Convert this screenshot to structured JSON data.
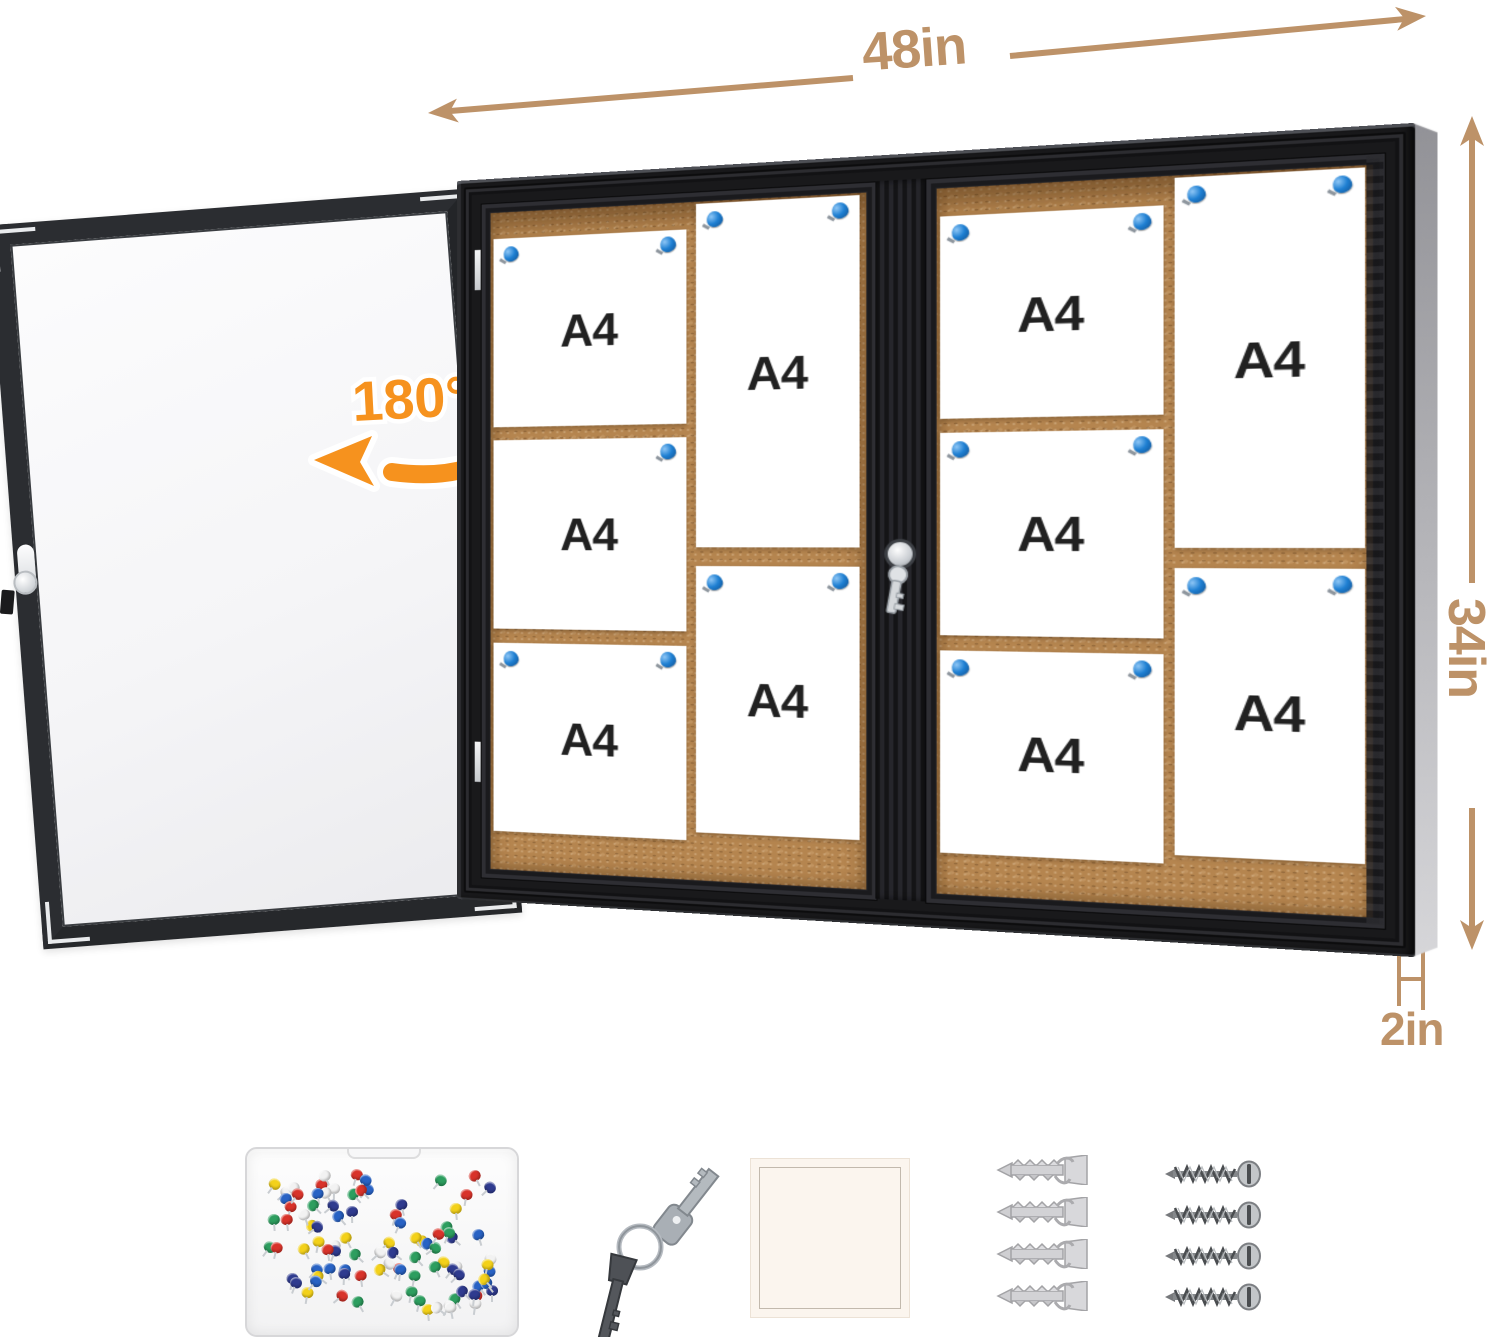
{
  "dimensions": {
    "width_label": "48in",
    "height_label": "34in",
    "depth_label": "2in"
  },
  "door": {
    "swing_label": "180°"
  },
  "board": {
    "paper_label": "A4",
    "sections": [
      {
        "name": "left-sliding-door",
        "landscape_papers": 3,
        "portrait_papers": 2
      },
      {
        "name": "right-sliding-door",
        "landscape_papers": 3,
        "portrait_papers": 2
      }
    ],
    "pins_per_paper": 2
  },
  "accessories": {
    "pushpin_box": {
      "pin_count": 96,
      "pin_colors": [
        "#d8332a",
        "#f3d11a",
        "#2862c4",
        "#2f3b8f",
        "#2d9e5f",
        "#f2f2f2"
      ]
    },
    "keys": {
      "count": 2
    },
    "adhesive_square": {
      "count": 1
    },
    "wall_anchors": {
      "count": 4
    },
    "screws": {
      "count": 4
    }
  },
  "icons": {
    "pushpin": "pushpin-icon",
    "key": "key-icon",
    "lock": "lock-cylinder-icon",
    "arrow": "dimension-arrow"
  },
  "colors": {
    "tan": "#bd9268",
    "orange": "#f6921e",
    "pin-blue": "#1e7fd2",
    "cork": "#b5854f",
    "frame": "#19191b",
    "paper": "#ffffff"
  }
}
